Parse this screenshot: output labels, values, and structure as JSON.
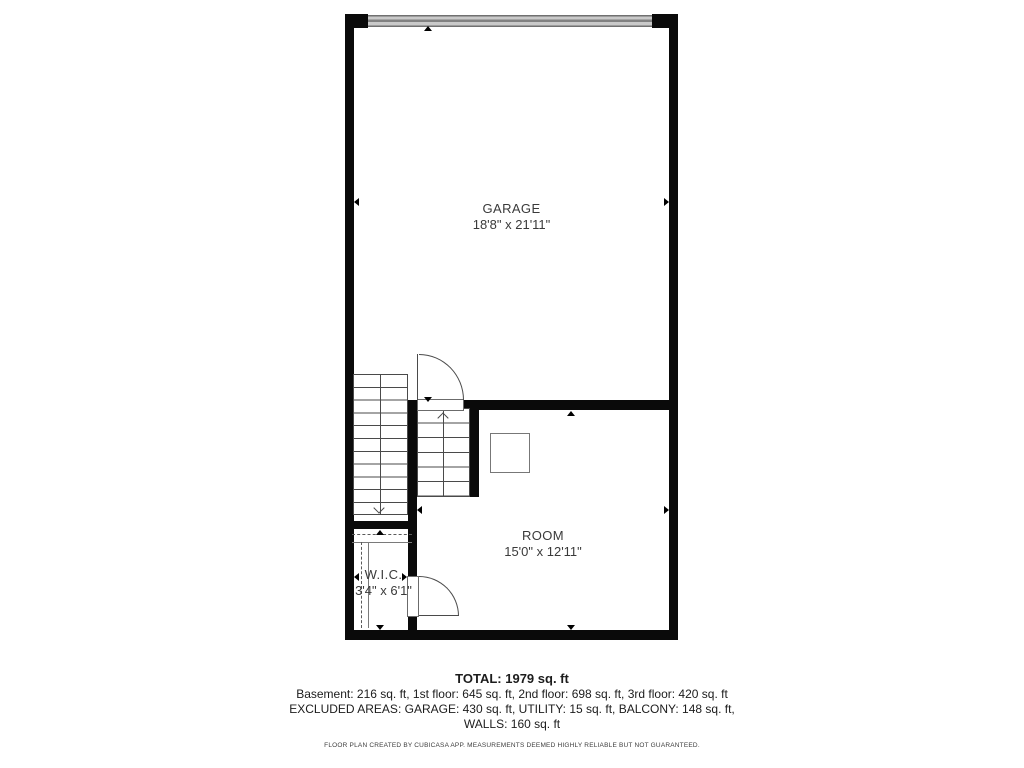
{
  "plan": {
    "rooms": [
      {
        "id": "garage",
        "name": "GARAGE",
        "dimensions": "18'8\" x 21'11\""
      },
      {
        "id": "room",
        "name": "ROOM",
        "dimensions": "15'0\" x 12'11\""
      },
      {
        "id": "wic",
        "name": "W.I.C.",
        "dimensions": "3'4\" x 6'1\""
      }
    ],
    "features": [
      "garage-door",
      "staircase-upper",
      "staircase-lower",
      "door-swing",
      "closet-rod",
      "wardrobe-square"
    ]
  },
  "summary": {
    "total": "TOTAL: 1979 sq. ft",
    "floors": "Basement: 216 sq. ft, 1st floor: 645 sq. ft, 2nd floor: 698 sq. ft, 3rd floor: 420 sq. ft",
    "excluded": "EXCLUDED AREAS: GARAGE: 430 sq. ft, UTILITY: 15 sq. ft, BALCONY: 148 sq. ft,",
    "walls": "WALLS: 160 sq. ft",
    "disclaimer": "FLOOR PLAN CREATED BY CUBICASA APP. MEASUREMENTS DEEMED HIGHLY RELIABLE BUT NOT GUARANTEED."
  },
  "colors": {
    "wall": "#0a0a0a",
    "line": "#4a4a4a",
    "garage_door_light": "#c9c9c9",
    "garage_door_dark": "#707070",
    "label_text": "#3a3a3a"
  }
}
